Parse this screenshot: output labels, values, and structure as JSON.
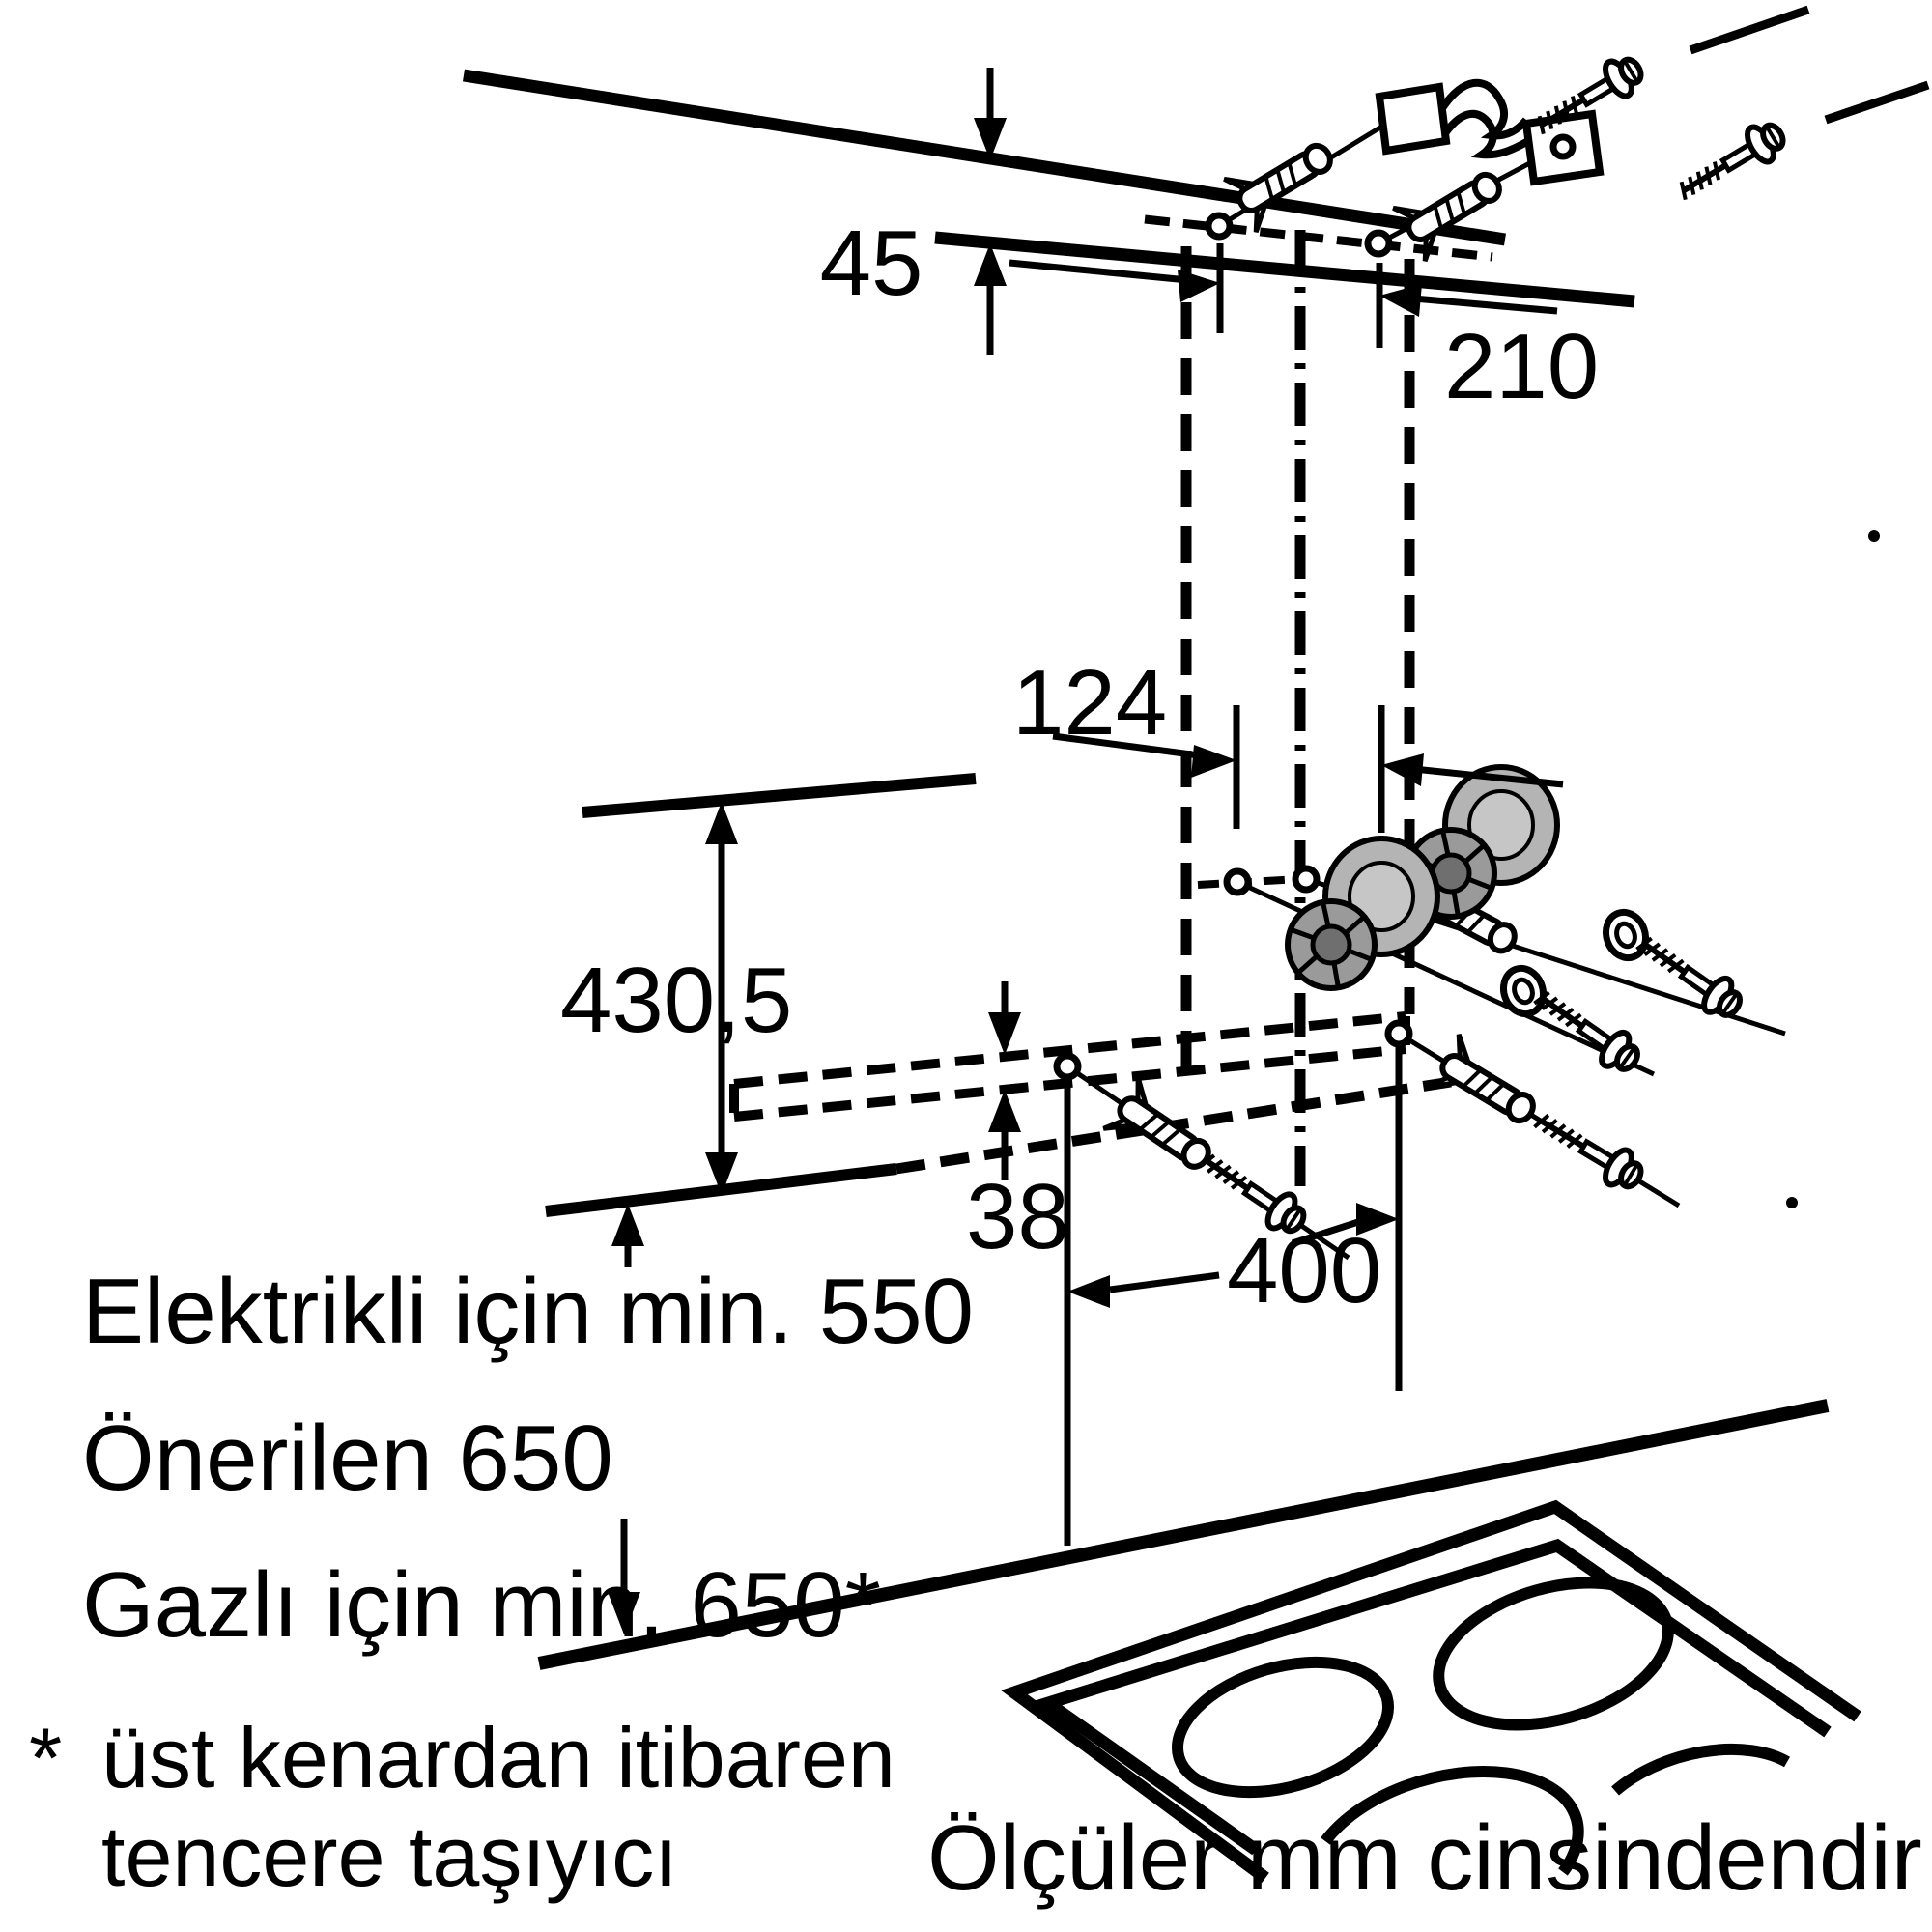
{
  "diagram": {
    "units_note": "Ölçüler mm cinsindendir",
    "dimensions": {
      "top_offset": "45",
      "upper_bracket_hole_spacing": "210",
      "chimney_hole_spacing": "124",
      "chimney_height": "430,5",
      "lower_bracket_height": "38",
      "lower_hole_spacing": "400"
    },
    "clearance_notes": {
      "line1": "Elektrikli için min. 550",
      "line2": "Önerilen 650",
      "line3": "Gazlı için min. 650*"
    },
    "footnote": {
      "marker": "*",
      "line1": "üst kenardan itibaren",
      "line2": "tencere taşıyıcı"
    },
    "colors": {
      "line": "#000000",
      "background": "#ffffff",
      "spacer_light": "#b4b4b4",
      "spacer_mid": "#9a9a9a",
      "spacer_dark": "#6f6f6f"
    }
  }
}
